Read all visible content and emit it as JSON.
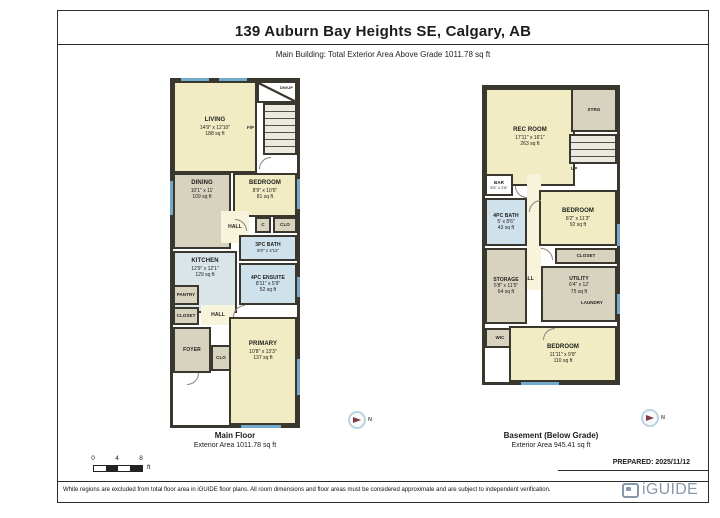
{
  "header": {
    "title": "139 Auburn Bay Heights SE, Calgary, AB",
    "subtitle": "Main Building: Total Exterior Area Above Grade 1011.78 sq ft"
  },
  "colors": {
    "wall": "#3a372f",
    "room_yellow": "#f1ecc3",
    "room_tan": "#d8d3bf",
    "room_blue": "#cfe1ea",
    "window_blue": "#74a9cc",
    "compass_arrow_red": "#7e3d44",
    "brand_blue": "#8798ab"
  },
  "main_floor": {
    "title": "Main Floor",
    "area": "Exterior Area 1011.78 sq ft",
    "rooms": {
      "living": {
        "name": "LIVING",
        "dims": "14'9\" x 12'10\"",
        "area": "188 sq ft"
      },
      "entry": {
        "name": "DN/UP"
      },
      "fireplace": {
        "name": "F/P"
      },
      "dining": {
        "name": "DINING",
        "dims": "10'1\" x 11'",
        "area": "109 sq ft"
      },
      "bedroom": {
        "name": "BEDROOM",
        "dims": "8'9\" x 10'6\"",
        "area": "81 sq ft"
      },
      "hall_upper": {
        "name": "HALL"
      },
      "closet_c": {
        "name": "C"
      },
      "closet_clo": {
        "name": "CLO"
      },
      "bath": {
        "name": "3PC BATH",
        "dims": "8'0\" x 4'11\""
      },
      "kitchen": {
        "name": "KITCHEN",
        "dims": "12'9\" x 12'1\"",
        "area": "129 sq ft"
      },
      "ensuite": {
        "name": "4PC ENSUITE",
        "dims": "8'11\" x 5'9\"",
        "area": "52 sq ft"
      },
      "pantry": {
        "name": "PANTRY"
      },
      "closet": {
        "name": "CLOSET"
      },
      "hall_lower": {
        "name": "HALL"
      },
      "foyer": {
        "name": "FOYER"
      },
      "clo": {
        "name": "CLO"
      },
      "primary": {
        "name": "PRIMARY",
        "dims": "10'8\" x 13'3\"",
        "area": "137 sq ft"
      }
    }
  },
  "basement": {
    "title": "Basement (Below Grade)",
    "area": "Exterior Area 945.41 sq ft",
    "rooms": {
      "rec_room": {
        "name": "REC ROOM",
        "dims": "17'11\" x 16'1\"",
        "area": "263 sq ft"
      },
      "strg": {
        "name": "STRG"
      },
      "stairs": {
        "name": "UP"
      },
      "bar": {
        "name": "BAR",
        "dims": "5'5\" x 2'6\""
      },
      "bath": {
        "name": "4PC BATH",
        "dims": "5' x 8'6\"",
        "area": "43 sq ft"
      },
      "bedroom1": {
        "name": "BEDROOM",
        "dims": "8'2\" x 11'3\"",
        "area": "92 sq ft"
      },
      "closet": {
        "name": "CLOSET"
      },
      "hall": {
        "name": "HALL"
      },
      "storage": {
        "name": "STORAGE",
        "dims": "5'8\" x 11'5\"",
        "area": "64 sq ft"
      },
      "utility": {
        "name": "UTILITY",
        "dims": "6'4\" x 12'",
        "area": "75 sq ft"
      },
      "laundry": {
        "name": "LAUNDRY"
      },
      "wic": {
        "name": "WIC"
      },
      "bedroom2": {
        "name": "BEDROOM",
        "dims": "11'11\" x 9'9\"",
        "area": "110 sq ft"
      }
    }
  },
  "compass": {
    "north": "N"
  },
  "scale_bar": {
    "zero": "0",
    "four": "4",
    "eight": "8",
    "unit": "ft"
  },
  "footer": {
    "prepared": "PREPARED: 2025/11/12",
    "disclaimer": "White regions are excluded from total floor area in iGUIDE floor plans. All room dimensions and floor areas must be considered approximate and are subject to independent verification.",
    "brand": "iGUIDE"
  }
}
